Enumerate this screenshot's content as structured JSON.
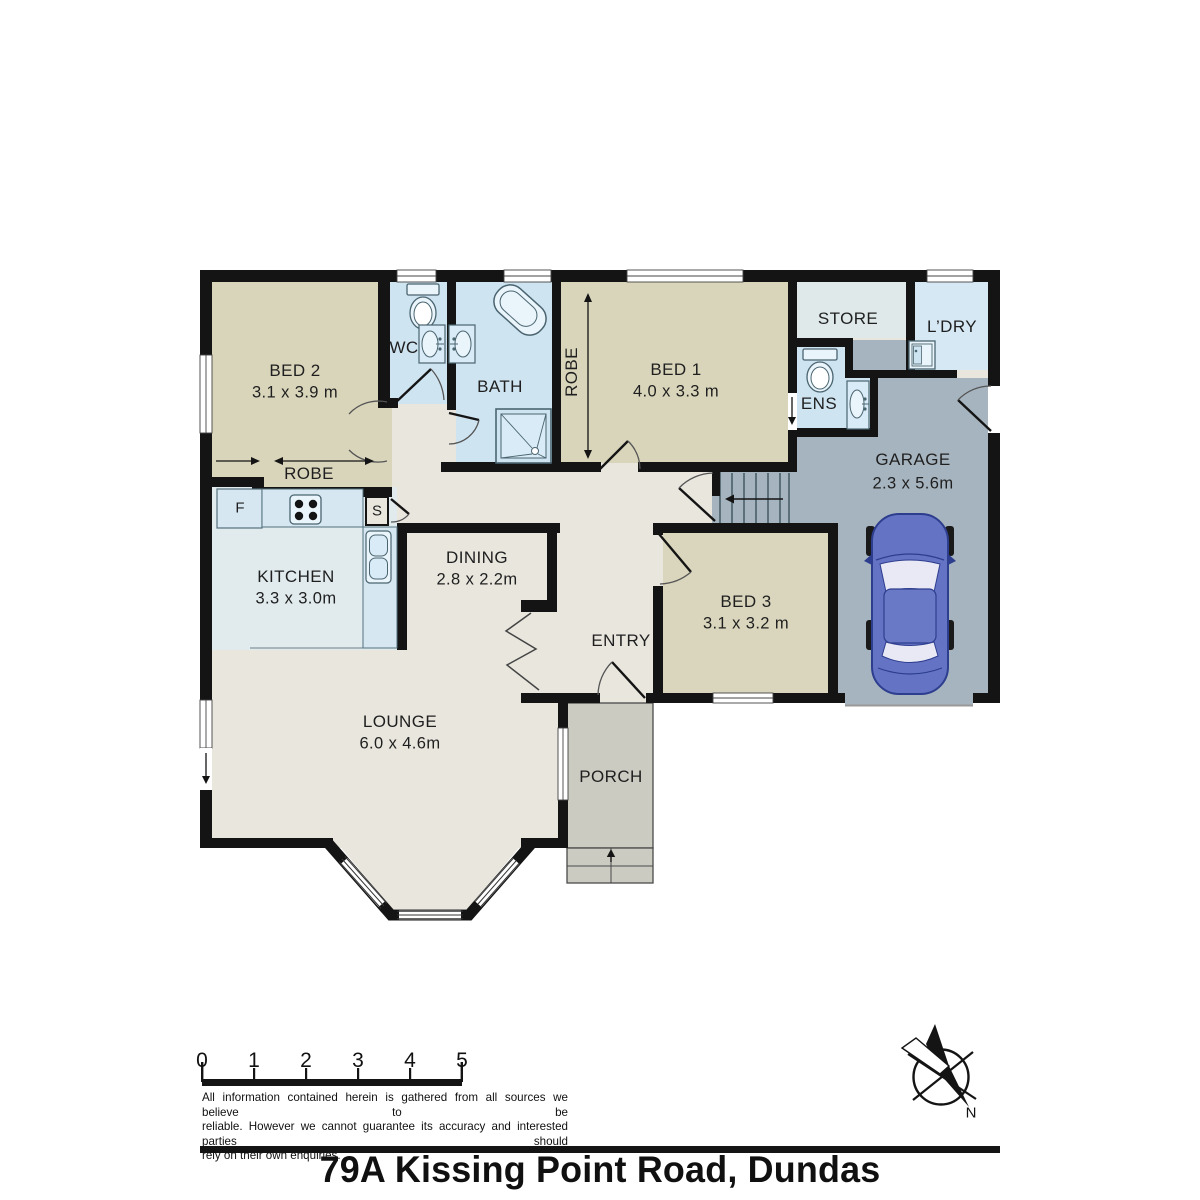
{
  "page": {
    "title": "79A Kissing Point Road, Dundas"
  },
  "rooms": {
    "bed1": {
      "name": "BED 1",
      "dims": "4.0 x 3.3 m"
    },
    "bed2": {
      "name": "BED 2",
      "dims": "3.1 x 3.9 m"
    },
    "bed3": {
      "name": "BED 3",
      "dims": "3.1 x 3.2 m"
    },
    "lounge": {
      "name": "LOUNGE",
      "dims": "6.0 x 4.6m"
    },
    "dining": {
      "name": "DINING",
      "dims": "2.8 x 2.2m"
    },
    "kitchen": {
      "name": "KITCHEN",
      "dims": "3.3 x 3.0m"
    },
    "garage": {
      "name": "GARAGE",
      "dims": "2.3 x 5.6m"
    },
    "bath": {
      "name": "BATH"
    },
    "wc": {
      "name": "WC"
    },
    "ens": {
      "name": "ENS"
    },
    "store": {
      "name": "STORE"
    },
    "laundry": {
      "name": "L’DRY"
    },
    "entry": {
      "name": "ENTRY"
    },
    "porch": {
      "name": "PORCH"
    },
    "robe_main": {
      "name": "ROBE"
    },
    "robe_bed2": {
      "name": "ROBE"
    }
  },
  "fixtures": {
    "fridge": "F",
    "cupboard": "S"
  },
  "scale_bar": {
    "ticks": [
      "0",
      "1",
      "2",
      "3",
      "4",
      "5"
    ]
  },
  "compass": {
    "north": "N"
  },
  "disclaimer": {
    "line1": "All information contained herein is gathered from all sources we believe to be",
    "line2": "reliable. However we cannot guarantee its accuracy and interested parties should",
    "line3": "rely on their own enquiries."
  },
  "colors": {
    "wall": "#141414",
    "bedroom_floor": "#d9d5bb",
    "wet_floor": "#cfe4f1",
    "hall_floor": "#e9e6de",
    "garage_floor": "#a6b4bf",
    "store_floor": "#dfe9ea",
    "kitchen_floor": "#e1ebee",
    "counter": "#d6e7f2",
    "porch_floor": "#cbcbc2",
    "car_body": "#6473c3"
  }
}
